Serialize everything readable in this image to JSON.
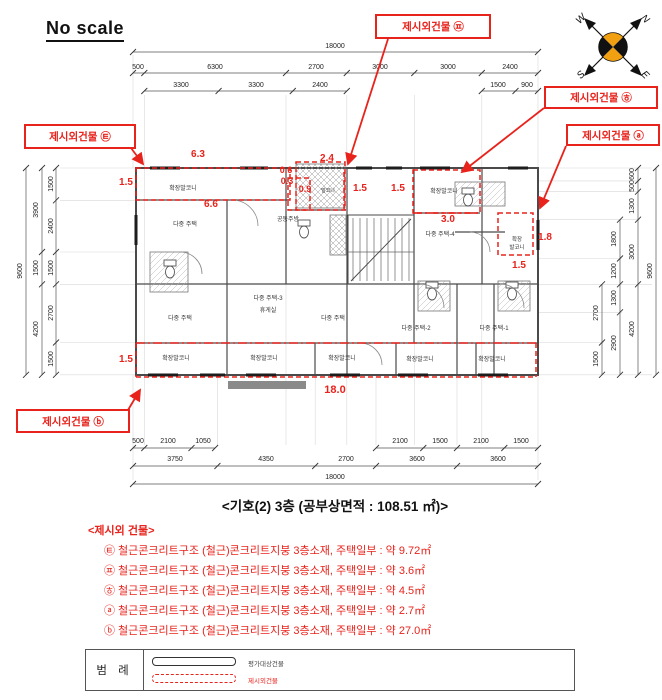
{
  "header": {
    "no_scale": "No scale"
  },
  "compass": {
    "w": "W",
    "n": "N",
    "s": "S",
    "e": "E"
  },
  "colors": {
    "red": "#e8231c",
    "wall": "#4a4a4a",
    "dim": "#222222",
    "grid": "#d8d8d8",
    "orange": "#f0a010"
  },
  "callouts": [
    {
      "label": "제시외건물 ㉬"
    },
    {
      "label": "제시외건물 ㉭"
    },
    {
      "label": "제시외건물 ⓐ"
    },
    {
      "label": "제시외건물 ㉫"
    },
    {
      "label": "제시외건물 ⓑ"
    }
  ],
  "plan": {
    "dim_labels": [
      {
        "t": "18000",
        "x": 335,
        "y": 48
      },
      {
        "t": "500",
        "x": 138,
        "y": 69
      },
      {
        "t": "6300",
        "x": 215,
        "y": 69
      },
      {
        "t": "2700",
        "x": 316,
        "y": 69
      },
      {
        "t": "3000",
        "x": 380,
        "y": 69
      },
      {
        "t": "3000",
        "x": 448,
        "y": 69
      },
      {
        "t": "2400",
        "x": 510,
        "y": 69
      },
      {
        "t": "3300",
        "x": 181,
        "y": 87
      },
      {
        "t": "3300",
        "x": 256,
        "y": 87
      },
      {
        "t": "2400",
        "x": 320,
        "y": 87
      },
      {
        "t": "1500",
        "x": 498,
        "y": 87
      },
      {
        "t": "900",
        "x": 527,
        "y": 87
      },
      {
        "t": "500",
        "x": 138,
        "y": 443
      },
      {
        "t": "2100",
        "x": 168,
        "y": 443
      },
      {
        "t": "1050",
        "x": 203,
        "y": 443
      },
      {
        "t": "2100",
        "x": 400,
        "y": 443
      },
      {
        "t": "1500",
        "x": 440,
        "y": 443
      },
      {
        "t": "2100",
        "x": 481,
        "y": 443
      },
      {
        "t": "1500",
        "x": 521,
        "y": 443
      },
      {
        "t": "3750",
        "x": 175,
        "y": 461
      },
      {
        "t": "4350",
        "x": 266,
        "y": 461
      },
      {
        "t": "2700",
        "x": 346,
        "y": 461
      },
      {
        "t": "3600",
        "x": 417,
        "y": 461
      },
      {
        "t": "3600",
        "x": 498,
        "y": 461
      },
      {
        "t": "18000",
        "x": 335,
        "y": 479
      },
      {
        "t": "9600",
        "x": 22,
        "y": 271,
        "rot": -90
      },
      {
        "t": "3900",
        "x": 38,
        "y": 210,
        "rot": -90
      },
      {
        "t": "1500",
        "x": 38,
        "y": 268,
        "rot": -90
      },
      {
        "t": "4200",
        "x": 38,
        "y": 329,
        "rot": -90
      },
      {
        "t": "1500",
        "x": 53,
        "y": 184,
        "rot": -90
      },
      {
        "t": "2400",
        "x": 53,
        "y": 226,
        "rot": -90
      },
      {
        "t": "1500",
        "x": 53,
        "y": 268,
        "rot": -90
      },
      {
        "t": "2700",
        "x": 53,
        "y": 313,
        "rot": -90
      },
      {
        "t": "1500",
        "x": 53,
        "y": 359,
        "rot": -90
      },
      {
        "t": "2700",
        "x": 598,
        "y": 313,
        "rot": -90
      },
      {
        "t": "1500",
        "x": 598,
        "y": 359,
        "rot": -90
      },
      {
        "t": "1800",
        "x": 616,
        "y": 239,
        "rot": -90
      },
      {
        "t": "1200",
        "x": 616,
        "y": 271,
        "rot": -90
      },
      {
        "t": "1300",
        "x": 616,
        "y": 298,
        "rot": -90
      },
      {
        "t": "2900",
        "x": 616,
        "y": 343,
        "rot": -90
      },
      {
        "t": "600",
        "x": 634,
        "y": 174,
        "rot": -90
      },
      {
        "t": "500",
        "x": 634,
        "y": 186,
        "rot": -90
      },
      {
        "t": "1300",
        "x": 634,
        "y": 206,
        "rot": -90
      },
      {
        "t": "3000",
        "x": 634,
        "y": 252,
        "rot": -90
      },
      {
        "t": "4200",
        "x": 634,
        "y": 329,
        "rot": -90
      },
      {
        "t": "9600",
        "x": 652,
        "y": 271,
        "rot": -90
      }
    ],
    "red_dims": [
      {
        "t": "1.5",
        "x": 126,
        "y": 185
      },
      {
        "t": "6.3",
        "x": 198,
        "y": 157
      },
      {
        "t": "6.6",
        "x": 211,
        "y": 207
      },
      {
        "t": "2.4",
        "x": 327,
        "y": 161
      },
      {
        "t": "0.6",
        "x": 286,
        "y": 173,
        "s": 9
      },
      {
        "t": "0.3",
        "x": 287,
        "y": 184,
        "s": 9
      },
      {
        "t": "0.9",
        "x": 305,
        "y": 192,
        "s": 9
      },
      {
        "t": "1.5",
        "x": 360,
        "y": 191
      },
      {
        "t": "1.5",
        "x": 398,
        "y": 191
      },
      {
        "t": "3.0",
        "x": 448,
        "y": 222
      },
      {
        "t": "1.8",
        "x": 545,
        "y": 240
      },
      {
        "t": "1.5",
        "x": 519,
        "y": 268
      },
      {
        "t": "1.5",
        "x": 126,
        "y": 362
      },
      {
        "t": "18.0",
        "x": 335,
        "y": 393,
        "s": 11
      }
    ],
    "room_labels": [
      {
        "t": "확장발코니",
        "x": 183,
        "y": 190
      },
      {
        "t": "다중 주택",
        "x": 185,
        "y": 226
      },
      {
        "t": "공동주방",
        "x": 288,
        "y": 221
      },
      {
        "t": "발코니",
        "x": 328,
        "y": 192,
        "s": 5
      },
      {
        "t": "확장발코니",
        "x": 444,
        "y": 193
      },
      {
        "t": "다중 주택-4",
        "x": 440,
        "y": 236
      },
      {
        "t": "확장",
        "x": 517,
        "y": 241,
        "s": 5.5
      },
      {
        "t": "발코니",
        "x": 517,
        "y": 249,
        "s": 5.5
      },
      {
        "t": "다중 주택-3",
        "x": 268,
        "y": 300
      },
      {
        "t": "휴게실",
        "x": 268,
        "y": 312
      },
      {
        "t": "다중 주택",
        "x": 180,
        "y": 320
      },
      {
        "t": "다중 주택",
        "x": 333,
        "y": 320
      },
      {
        "t": "다중 주택-2",
        "x": 416,
        "y": 330
      },
      {
        "t": "다중 주택-1",
        "x": 494,
        "y": 330
      },
      {
        "t": "확장발코니",
        "x": 176,
        "y": 360
      },
      {
        "t": "확장발코니",
        "x": 264,
        "y": 360
      },
      {
        "t": "확장발코니",
        "x": 342,
        "y": 360
      },
      {
        "t": "확장발코니",
        "x": 420,
        "y": 361
      },
      {
        "t": "확장발코니",
        "x": 492,
        "y": 361
      }
    ]
  },
  "title": "<기호(2) 3층 (공부상면적 : 108.51 ㎡)>",
  "list": {
    "header": "<제시외 건물>",
    "items": [
      "㉫ 철근콘크리트구조 (철근)콘크리트지붕 3층소재, 주택일부 : 약 9.72㎡",
      "㉬ 철근콘크리트구조 (철근)콘크리트지붕 3층소재, 주택일부 : 약 3.6㎡",
      "㉭ 철근콘크리트구조 (철근)콘크리트지붕 3층소재, 주택일부 : 약 4.5㎡",
      "ⓐ 철근콘크리트구조 (철근)콘크리트지붕 3층소재, 주택일부 : 약 2.7㎡",
      "ⓑ 철근콘크리트구조 (철근)콘크리트지붕 3층소재, 주택일부 : 약 27.0㎡"
    ]
  },
  "legend": {
    "title": "범 례",
    "items": [
      {
        "label": "평가대상건물",
        "style": "solid"
      },
      {
        "label": "제시외건물",
        "style": "dashed"
      }
    ]
  }
}
